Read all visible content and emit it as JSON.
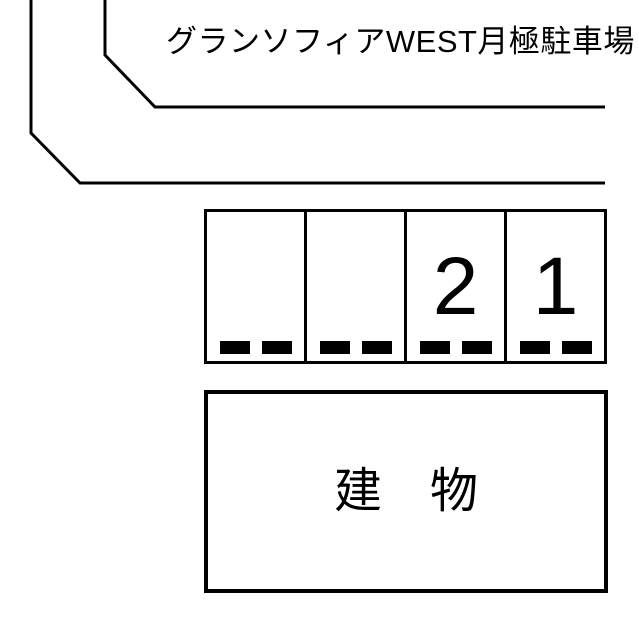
{
  "diagram": {
    "title": "グランソフィアWEST月極駐車場",
    "building_label": "建　物",
    "stalls": [
      {
        "number": ""
      },
      {
        "number": ""
      },
      {
        "number": "2"
      },
      {
        "number": "1"
      }
    ]
  },
  "colors": {
    "line": "#000000",
    "background": "#ffffff",
    "text": "#000000"
  }
}
